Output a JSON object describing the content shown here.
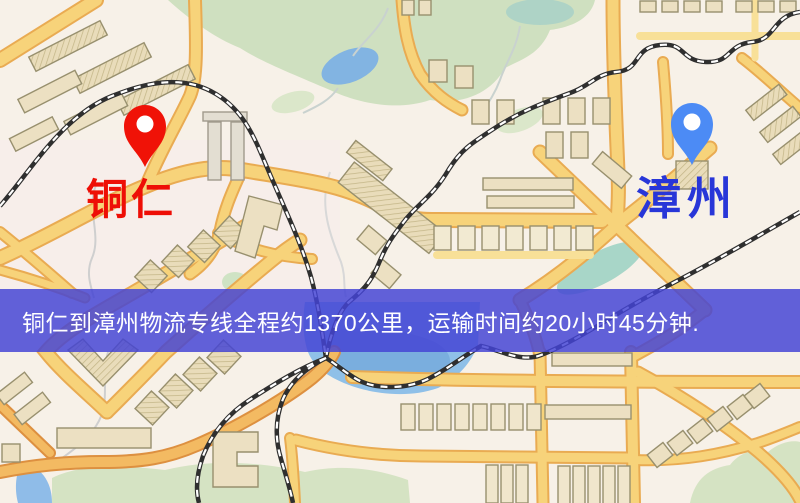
{
  "map": {
    "origin_marker": {
      "label": "铜仁",
      "pin_color": "#f01207",
      "label_color": "#ee0e06"
    },
    "destination_marker": {
      "label": "漳州",
      "pin_color": "#4c8bf5",
      "label_color": "#2836d8"
    },
    "info_banner": {
      "text": "铜仁到漳州物流专线全程约1370公里，运输时间约20小时45分钟.",
      "background_color": "#4444d4",
      "text_color": "#ffffff"
    },
    "legend_colors": {
      "background": "#f7f1e8",
      "road": "#f7d37a",
      "road_casing": "#e9ab52",
      "orange_road": "#f3ba62",
      "building": "#ece0c2",
      "park": "#d5e3c3",
      "water": "#8fc0e8",
      "railway": "#2f2f2f"
    }
  }
}
